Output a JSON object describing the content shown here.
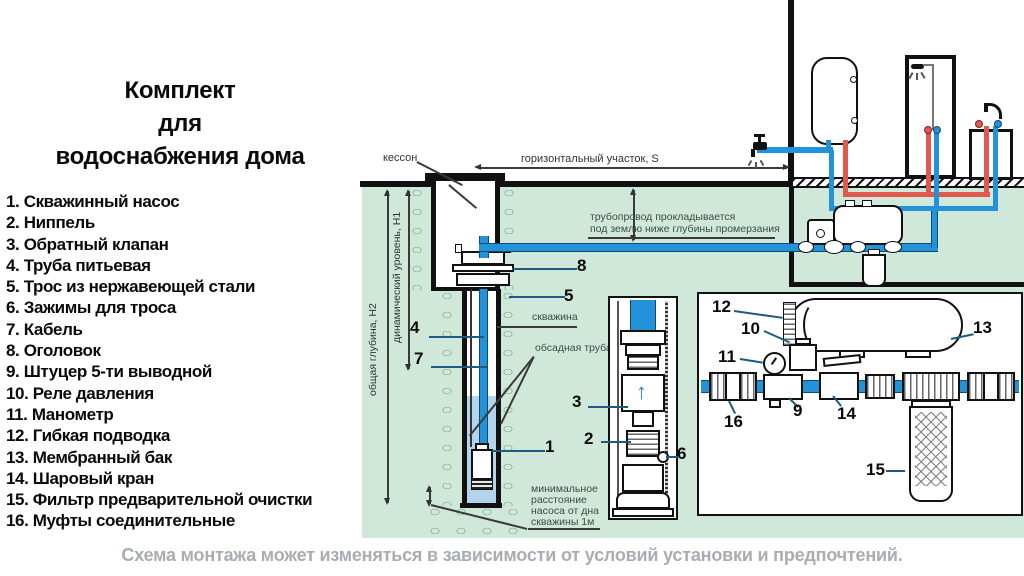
{
  "title": {
    "line1": "Комплект",
    "line2": "для",
    "line3": "водоснабжения дома"
  },
  "legend": {
    "items": [
      "1. Скважинный насос",
      "2. Ниппель",
      "3. Обратный клапан",
      "4. Труба питьевая",
      "5. Трос из нержавеющей стали",
      "6. Зажимы для троса",
      "7. Кабель",
      "8. Оголовок",
      "9. Штуцер 5-ти выводной",
      "10. Реле давления",
      "11. Манометр",
      "12. Гибкая подводка",
      "13. Мембранный бак",
      "14. Шаровый кран",
      "15. Фильтр предварительной очистки",
      "16. Муфты соединительные"
    ]
  },
  "caption": "Схема монтажа может изменяться в зависимости от условий установки и предпочтений.",
  "diagram": {
    "labels": {
      "kesson": "кессон",
      "horizontal_section": "горизонтальный участок, S",
      "pipeline_note_line1": "трубопровод прокладывается",
      "pipeline_note_line2": "под землю ниже глубины промерзания",
      "well": "скважина",
      "casing": "обсадная труба",
      "total_depth": "общая глубина, Н2",
      "dynamic_level": "динамический уровень, Н1",
      "min_distance_line1": "минимальное",
      "min_distance_line2": "расстояние",
      "min_distance_line3": "насоса от дна",
      "min_distance_line4": "скважины 1м",
      "valve_arrow": "↑"
    },
    "callouts": {
      "pump": "1",
      "nipple": "2",
      "check_valve": "3",
      "drink_pipe": "4",
      "steel_cable": "5",
      "cable_clamp": "6",
      "cable": "7",
      "wellhead": "8",
      "five_way_fitting": "9",
      "pressure_relay": "10",
      "manometer": "11",
      "flex_hose": "12",
      "membrane_tank": "13",
      "ball_valve": "14",
      "pre_filter": "15",
      "coupling": "16"
    },
    "colors": {
      "ground": "#cfe8da",
      "pipe_cold": "#2293d8",
      "pipe_hot": "#e2574e",
      "water": "#b3d4ea",
      "caption_gray": "#a7adb3"
    }
  }
}
